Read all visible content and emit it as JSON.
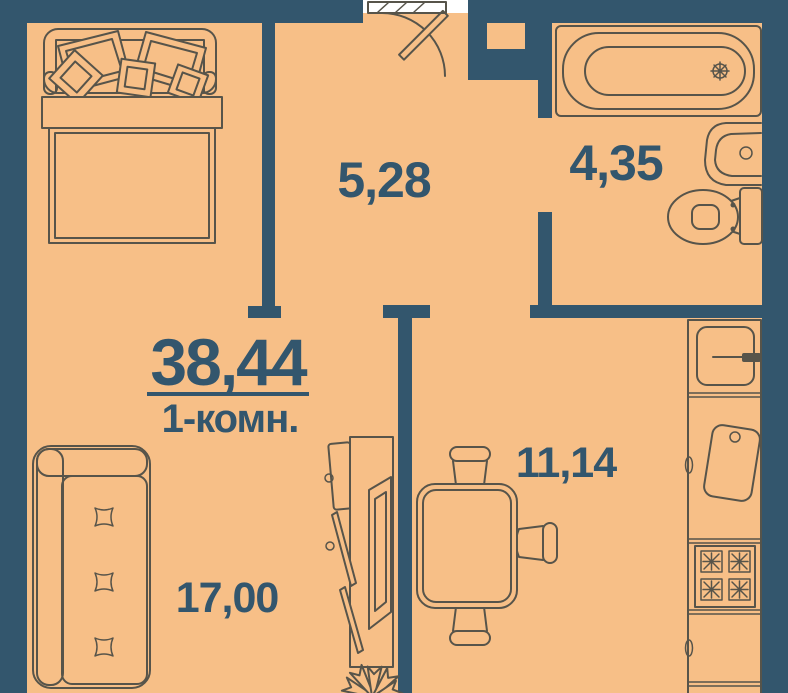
{
  "plan": {
    "total_area": "38,44",
    "layout_type": "1-комн.",
    "rooms": {
      "hallway": {
        "area": "5,28"
      },
      "bathroom": {
        "area": "4,35"
      },
      "kitchen_dining": {
        "area": "11,14"
      },
      "living_room": {
        "area": "17,00"
      }
    },
    "furniture": [
      "double-bed",
      "sofa",
      "desk-with-tv",
      "plant",
      "dining-table",
      "chairs",
      "bathtub",
      "washbasin",
      "toilet",
      "fridge",
      "kitchen-sink",
      "stove",
      "counter",
      "entrance-door"
    ]
  },
  "colors": {
    "wall": "#33566d",
    "floor": "#f7bf87",
    "line": "#57544a",
    "text": "#33566d",
    "outside": "#ffffff"
  }
}
